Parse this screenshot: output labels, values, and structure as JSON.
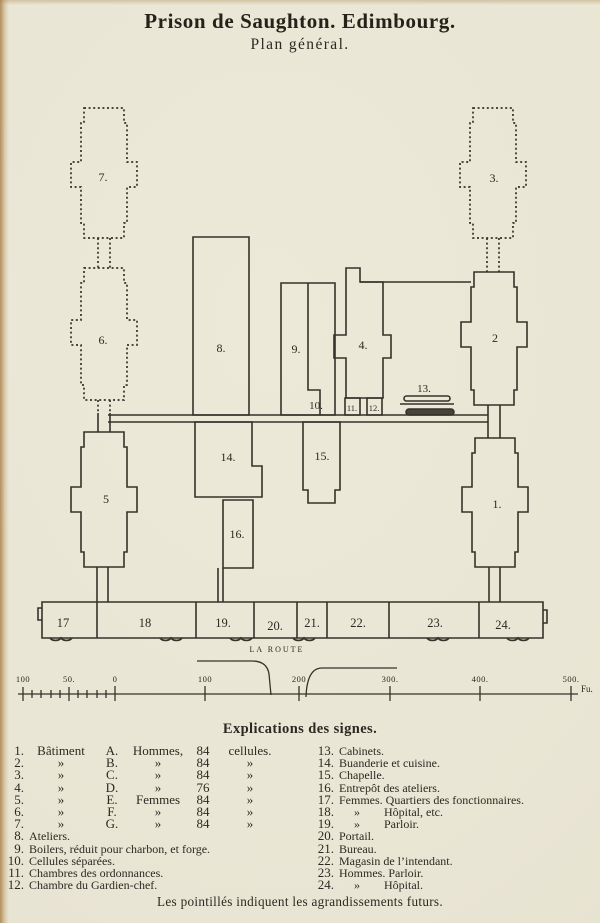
{
  "page": {
    "title": "Prison de Saughton. Edimbourg.",
    "subtitle": "Plan général.",
    "footer_note": "Les pointillés indiquent les agrandissements futurs."
  },
  "plan": {
    "road_label": "LA ROUTE",
    "labels": {
      "b1": "1.",
      "b2": "2",
      "b3": "3.",
      "b4": "4.",
      "b5": "5",
      "b6": "6.",
      "b7": "7.",
      "b8": "8.",
      "b9": "9.",
      "b10": "10.",
      "b11": "11.",
      "b12": "12.",
      "b13": "13.",
      "b14": "14.",
      "b15": "15.",
      "b16": "16.",
      "r17": "17",
      "r18": "18",
      "r19": "19.",
      "r20": "20.",
      "r21": "21.",
      "r22": "22.",
      "r23": "23.",
      "r24": "24."
    }
  },
  "scale": {
    "ticks": [
      "100",
      "50.",
      "0",
      "100",
      "200",
      "300.",
      "400.",
      "500."
    ],
    "unit": "Fu."
  },
  "legend": {
    "heading": "Explications des signes.",
    "left_rows": [
      {
        "num": "1.",
        "c1": "Bâtiment",
        "c2": "A.",
        "c3": "Hommes,",
        "c4": "84",
        "c5": "cellules."
      },
      {
        "num": "2.",
        "c1": "»",
        "c2": "B.",
        "c3": "»",
        "c4": "84",
        "c5": "»"
      },
      {
        "num": "3.",
        "c1": "»",
        "c2": "C.",
        "c3": "»",
        "c4": "84",
        "c5": "»"
      },
      {
        "num": "4.",
        "c1": "»",
        "c2": "D.",
        "c3": "»",
        "c4": "76",
        "c5": "»"
      },
      {
        "num": "5.",
        "c1": "»",
        "c2": "E.",
        "c3": "Femmes",
        "c4": "84",
        "c5": "»"
      },
      {
        "num": "6.",
        "c1": "»",
        "c2": "F.",
        "c3": "»",
        "c4": "84",
        "c5": "»"
      },
      {
        "num": "7.",
        "c1": "»",
        "c2": "G.",
        "c3": "»",
        "c4": "84",
        "c5": "»"
      }
    ],
    "left_items": [
      {
        "num": "8.",
        "text": "Ateliers."
      },
      {
        "num": "9.",
        "text": "Boilers, réduit pour charbon, et forge."
      },
      {
        "num": "10.",
        "text": "Cellules séparées."
      },
      {
        "num": "11.",
        "text": "Chambres des ordonnances."
      },
      {
        "num": "12.",
        "text": "Chambre du Gardien-chef."
      }
    ],
    "right_items": [
      {
        "num": "13.",
        "text": "Cabinets."
      },
      {
        "num": "14.",
        "text": "Buanderie et cuisine."
      },
      {
        "num": "15.",
        "text": "Chapelle."
      },
      {
        "num": "16.",
        "text": "Entrepôt des ateliers."
      },
      {
        "num": "17.",
        "text": "Femmes. Quartiers des fonctionnaires."
      },
      {
        "num": "18.",
        "text": "     »        Hôpital, etc."
      },
      {
        "num": "19.",
        "text": "     »        Parloir."
      },
      {
        "num": "20.",
        "text": "Portail."
      },
      {
        "num": "21.",
        "text": "Bureau."
      },
      {
        "num": "22.",
        "text": "Magasin de l’intendant."
      },
      {
        "num": "23.",
        "text": "Hommes. Parloir."
      },
      {
        "num": "24.",
        "text": "     »        Hôpital."
      }
    ]
  },
  "colors": {
    "paper": "#e9e5d4",
    "ink": "#2e2c23"
  }
}
